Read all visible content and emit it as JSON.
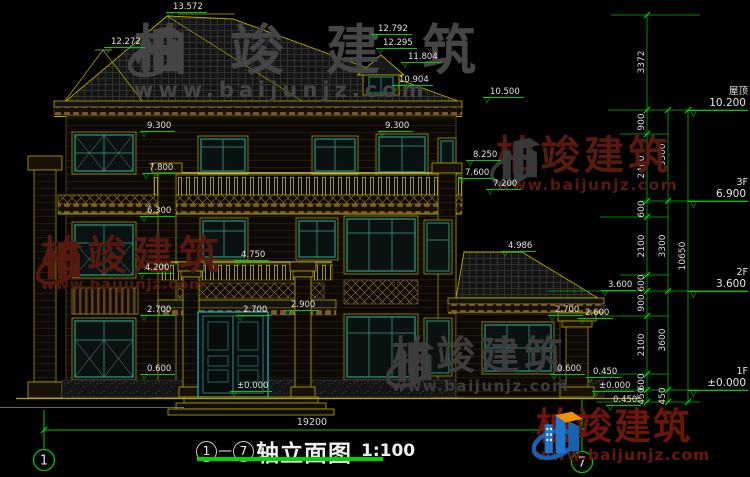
{
  "watermarks": {
    "brand": "柏竣建筑",
    "site": "www.baijunjz.com"
  },
  "drawing": {
    "axis_start": "1",
    "axis_end": "7",
    "separator": "—",
    "title": "轴立面图",
    "scale": "1:100",
    "dimension_total": "19200"
  },
  "levels_right": [
    {
      "name": "屋顶",
      "elev": "10.200"
    },
    {
      "name": "3F",
      "elev": "6.900"
    },
    {
      "name": "2F",
      "elev": "3.600"
    },
    {
      "name": "1F",
      "elev": "±0.000"
    }
  ],
  "dim_col1": [
    "3372",
    "900",
    "2400",
    "600",
    "2100",
    "600",
    "900",
    "2100",
    "600",
    "450"
  ],
  "dim_col2": [
    "3300",
    "3300",
    "3600",
    "450"
  ],
  "dim_col3": [
    "10650"
  ],
  "markers": [
    "13.572",
    "12.272",
    "12.792",
    "12.295",
    "11.804",
    "10.904",
    "10.500",
    "9.300",
    "9.300",
    "7.800",
    "8.250",
    "7.600",
    "7.200",
    "6.300",
    "4.750",
    "4.200",
    "4.986",
    "3.600",
    "2.700",
    "2.900",
    "2.700",
    "2.700",
    "2.600",
    "0.600",
    "0.600",
    "0.450",
    "±0.000",
    "0.450",
    "±0.000"
  ],
  "icons": {
    "level_marker": "▽"
  },
  "colors": {
    "background": "#000000",
    "cad_green": "#00c800",
    "cad_yellow": "#b8a800",
    "text_white": "#e2e2e2",
    "window_teal": "#2e7d6e",
    "door_cyan": "#00b4c4",
    "watermark_red": "#561a0e",
    "watermark_gray": "#3f3f3f",
    "logo_blue": "#1e77cc",
    "logo_orange": "#f39000"
  }
}
